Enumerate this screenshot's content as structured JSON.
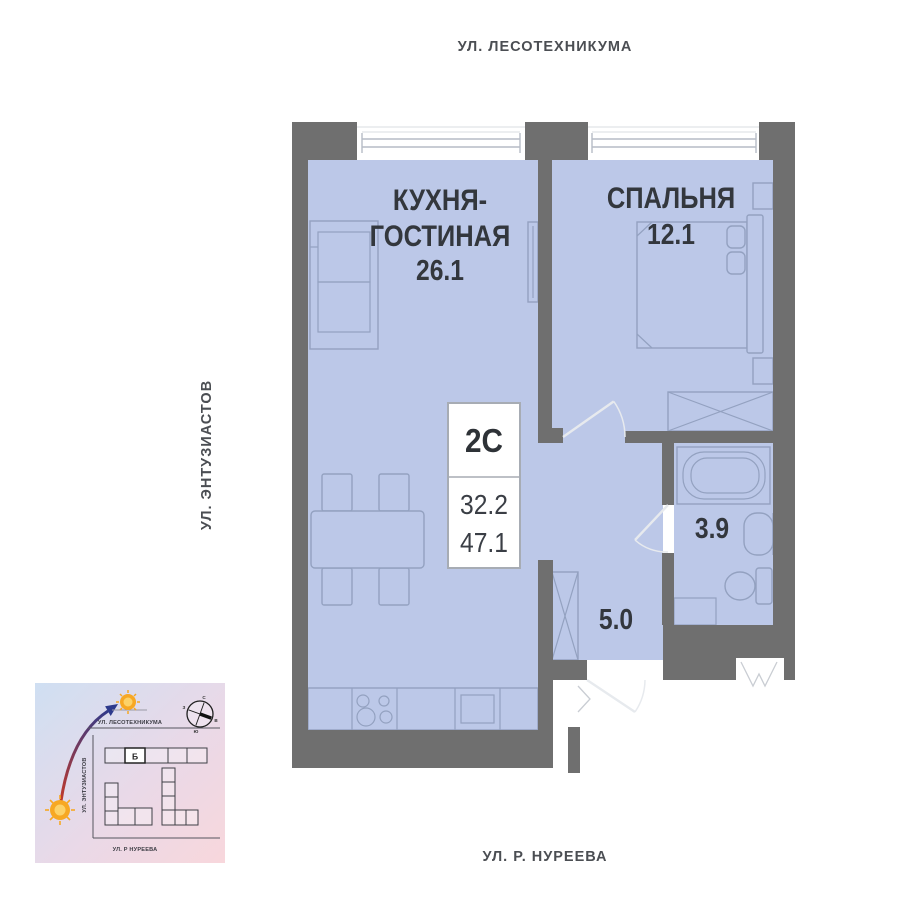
{
  "streets": {
    "top": "УЛ. ЛЕСОТЕХНИКУМА",
    "left": "УЛ. ЭНТУЗИАСТОВ",
    "bottom": "УЛ. Р. НУРЕЕВА"
  },
  "rooms": {
    "kitchen_living": {
      "label_line1": "КУХНЯ-",
      "label_line2": "ГОСТИНАЯ",
      "area": "26.1"
    },
    "bedroom": {
      "label": "СПАЛЬНЯ",
      "area": "12.1"
    },
    "bathroom": {
      "area": "3.9"
    },
    "hallway": {
      "area": "5.0"
    }
  },
  "info_box": {
    "unit_type": "2С",
    "living_area": "32.2",
    "total_area": "47.1"
  },
  "minimap": {
    "building_label": "Б",
    "streets": {
      "top": "УЛ. ЛЕСОТЕХНИКУМА",
      "left": "УЛ. ЭНТУЗИАСТОВ",
      "bottom": "УЛ. Р НУРЕЕВА"
    },
    "compass": {
      "n": "С",
      "e": "В",
      "s": "Ю",
      "w": "З"
    }
  },
  "colors": {
    "background": "#ffffff",
    "wall": "#6f6f6f",
    "floor": "#bcc8e8",
    "furniture_line": "#93a1c0",
    "label_text": "#33373d",
    "street_text": "#4b4e53",
    "minimap_gradient_start": "#cfdff2",
    "minimap_gradient_end": "#f8d7dc",
    "sun": "#f7a823",
    "arrow_red": "#c0392b",
    "arrow_blue": "#2e3a8c"
  }
}
